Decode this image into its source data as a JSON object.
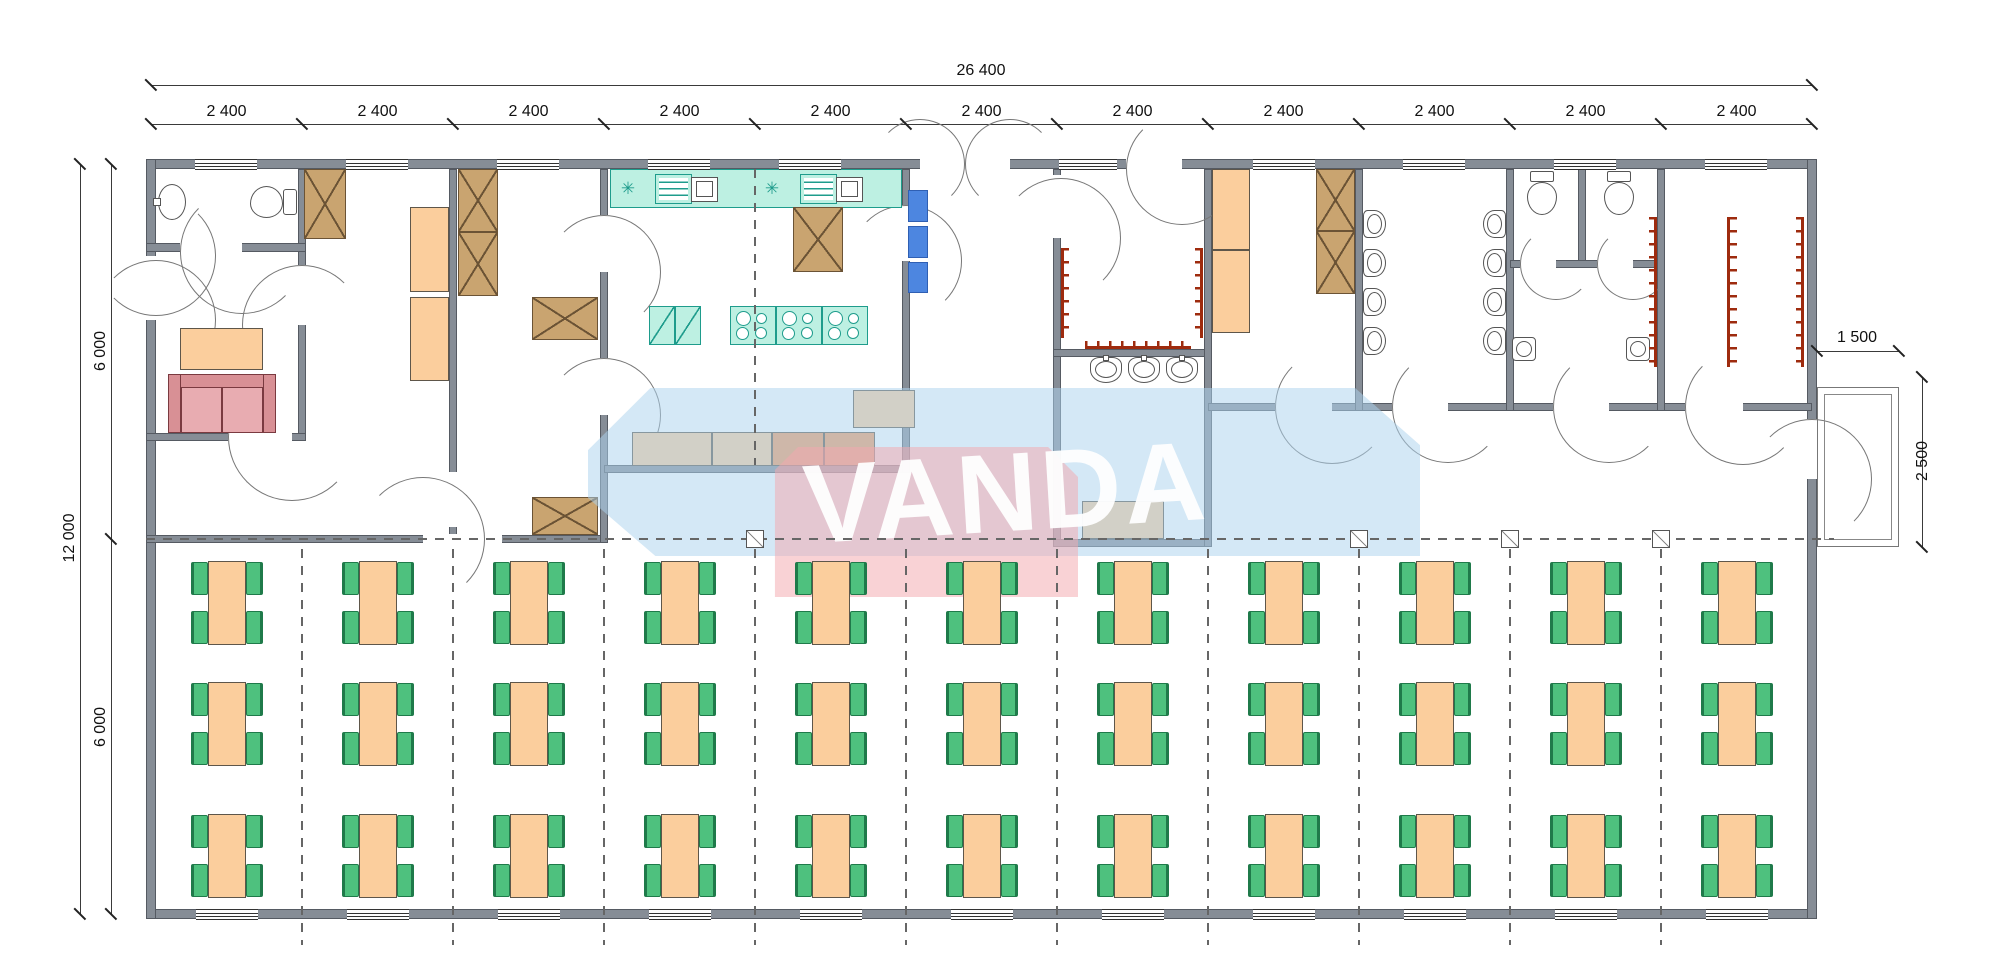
{
  "dimensions": {
    "overall_width_label": "26 400",
    "bay_labels": [
      "2 400",
      "2 400",
      "2 400",
      "2 400",
      "2 400",
      "2 400",
      "2 400",
      "2 400",
      "2 400",
      "2 400",
      "2 400"
    ],
    "overall_height_label": "12 000",
    "height_segment_labels": [
      "6 000",
      "6 000"
    ],
    "porch_width_label": "1 500",
    "porch_depth_label": "2 500"
  },
  "watermark": {
    "text": "VANDA",
    "shape_blue": "#ADD3EE",
    "shape_pink": "#F3A9AF",
    "text_color": "#FFFFFF"
  },
  "icons": {
    "cooker_symbol": "✳"
  },
  "colors": {
    "wall": "#868D96",
    "kitchen_unit": "#BDF0E2",
    "kitchen_unit_border": "#1E9C8C",
    "cabinet_wood": "#C9A470",
    "table_orange": "#FBCE9D",
    "counter_dark": "#F2995E",
    "shelf_blue": "#4D86E0",
    "sofa_dark": "#D89095",
    "sofa_light": "#E8ACB1",
    "chair_green": "#4EC17E",
    "coat_hooks_red": "#9E2B0E"
  },
  "dining": {
    "columns": 11,
    "rows": 3
  },
  "fixtures": {
    "bathroom": [
      "wash-sink",
      "toilet"
    ],
    "lounge": [
      "coffee-table",
      "sofa"
    ],
    "kitchen": [
      "counter-with-two-sinks",
      "two-refrigerators",
      "three-stoves",
      "serving-counter"
    ],
    "mudroom_basins": 3,
    "washroom_basins_per_side": 4,
    "wc_toilets": 2,
    "wc_corner_basins": 2,
    "coat_hook_strips": 6,
    "dining_tables": 33,
    "chairs_per_table": 4
  }
}
